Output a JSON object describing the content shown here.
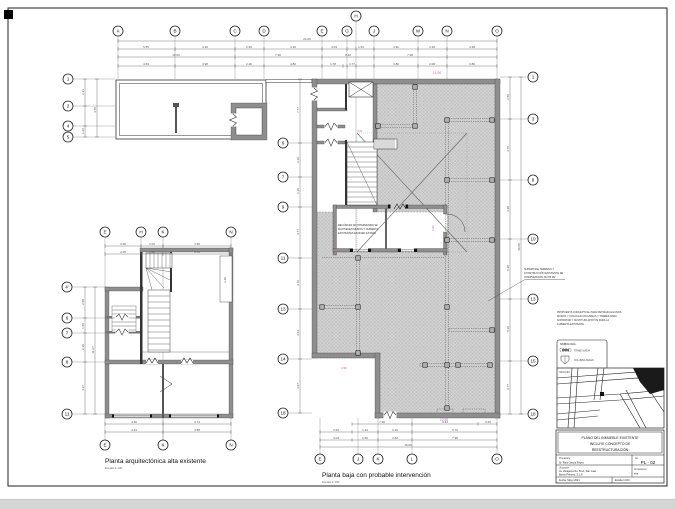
{
  "plans": {
    "alta": {
      "title": "Planta arquitectónica alta existente",
      "scale": "Escala 1:100"
    },
    "baja": {
      "title": "Planta baja con probable intervención",
      "scale": "Escala 1:100"
    }
  },
  "grid": {
    "top": [
      "A",
      "B",
      "C",
      "D",
      "E",
      "G",
      "H",
      "J",
      "M",
      "N",
      "O"
    ],
    "wing_left": [
      "1",
      "2",
      "4",
      "5"
    ],
    "baja_left": [
      "6",
      "7",
      "9",
      "11",
      "13",
      "14",
      "18"
    ],
    "baja_right": [
      "1",
      "3",
      "8",
      "10",
      "13",
      "15",
      "18"
    ],
    "baja_bottom": [
      "E",
      "J",
      "K",
      "L",
      "O"
    ],
    "alta_top": [
      "E",
      "H",
      "K",
      "N"
    ],
    "alta_left": [
      "4'",
      "6",
      "7",
      "8",
      "11"
    ],
    "alta_bottom": [
      "E",
      "K",
      "N"
    ]
  },
  "dims": {
    "top_total": "24.00",
    "top_row1": [
      "5.55",
      "4.90",
      "2.20",
      "4.90",
      "4.03",
      "1.54",
      "4.90",
      "2.92",
      "4.98"
    ],
    "top_row2": [
      "10.00",
      "7.90",
      "8.40",
      "7.98"
    ],
    "top_row3": [
      "4.63",
      "4.98",
      "2.20",
      "4.80",
      "1.78",
      "1.77",
      "3.80",
      "2.08",
      "3.80"
    ],
    "baja_bottom_row1": [
      "7.90",
      "3.13",
      "0.60"
    ],
    "baja_bottom_row2": [
      "2.52",
      "1.33",
      "3.10",
      "6.70"
    ],
    "baja_bottom_row3": [
      "4.03",
      "1.50",
      "3.52",
      "7.98"
    ],
    "baja_bottom_total": "18.06",
    "baja_left": [
      "7.77",
      "2.28",
      "1.25",
      "4.77",
      "4.70",
      "4.54",
      "4.57"
    ],
    "baja_right": [
      "2.50",
      "4.70",
      "4.98",
      "5.20",
      "5.20",
      "6.77"
    ],
    "baja_right_total": "30.08",
    "wing_left": [
      "2.33",
      "1.26",
      "4.70"
    ],
    "alta_top_row1": [
      "3.26",
      "2.02",
      "4.58"
    ],
    "alta_top_row2": [
      "2.05",
      "1.80",
      "5.75"
    ],
    "alta_bottom_row1": [
      "4.50",
      "3.73"
    ],
    "alta_bottom_row2": [
      "4.43",
      "4.58"
    ],
    "alta_left": [
      "2.58",
      "1.50",
      "2.30",
      "4.37"
    ],
    "alta_left_total": "11.27",
    "closet": "1.40"
  },
  "pink": [
    "11.00",
    "3.01",
    "0.60",
    "0.90",
    "4.90",
    "12.55"
  ],
  "annotations": {
    "room_note": [
      "RECÁMARA NO INTERVENIDA SE",
      "MANTIENEN MUROS Y CUBIERTA",
      "EXISTENTES EN BUEN ESTADO"
    ],
    "area_note": [
      "SUPERFICIE TERRENO Y",
      "CONSTRUCCIÓN EXISTENTE DE",
      "INTERVENCIÓN 302.55 M2"
    ]
  },
  "notes": {
    "lines": [
      "PROPUESTA CONCEPTUAL PARA RETIRAR ALGUNOS",
      "MUROS Y COLOCAR COLUMNAS Y TRABES PARA",
      "SOPORTAR Y SUSTITUIR APOYOS PARA LA",
      "CUBIERTA EXISTENTE."
    ]
  },
  "legend": {
    "title": "SIMBOLOGÍA",
    "items": [
      {
        "label": "TRABE NUEVA"
      },
      {
        "label": "COLUMNA NUEVA"
      }
    ]
  },
  "croquis": {
    "label": "CROQUIS"
  },
  "titleblock": {
    "title_lines": [
      "PLANO DEL INMUEBLE EXISTENTE",
      "INCLUYE CONCEPTO DE",
      "REESTRUCTURACIÓN"
    ],
    "fields": {
      "propietario_label": "Propietario:",
      "propietario": "Sr. Raúl García Reyes",
      "no_label": "No.",
      "no": "PL - 02",
      "ubicacion_label": "Ubicación:",
      "ubicacion_1": "Av. Zaragoza No. 30-A, San Juan",
      "ubicacion_2": "Barrio Primero, S.L.P.",
      "acotaciones_label": "Acotaciones:",
      "acotaciones": "mts.",
      "fecha": "Fecha: Mayo 2021",
      "escala": "Escala 1:100"
    }
  }
}
